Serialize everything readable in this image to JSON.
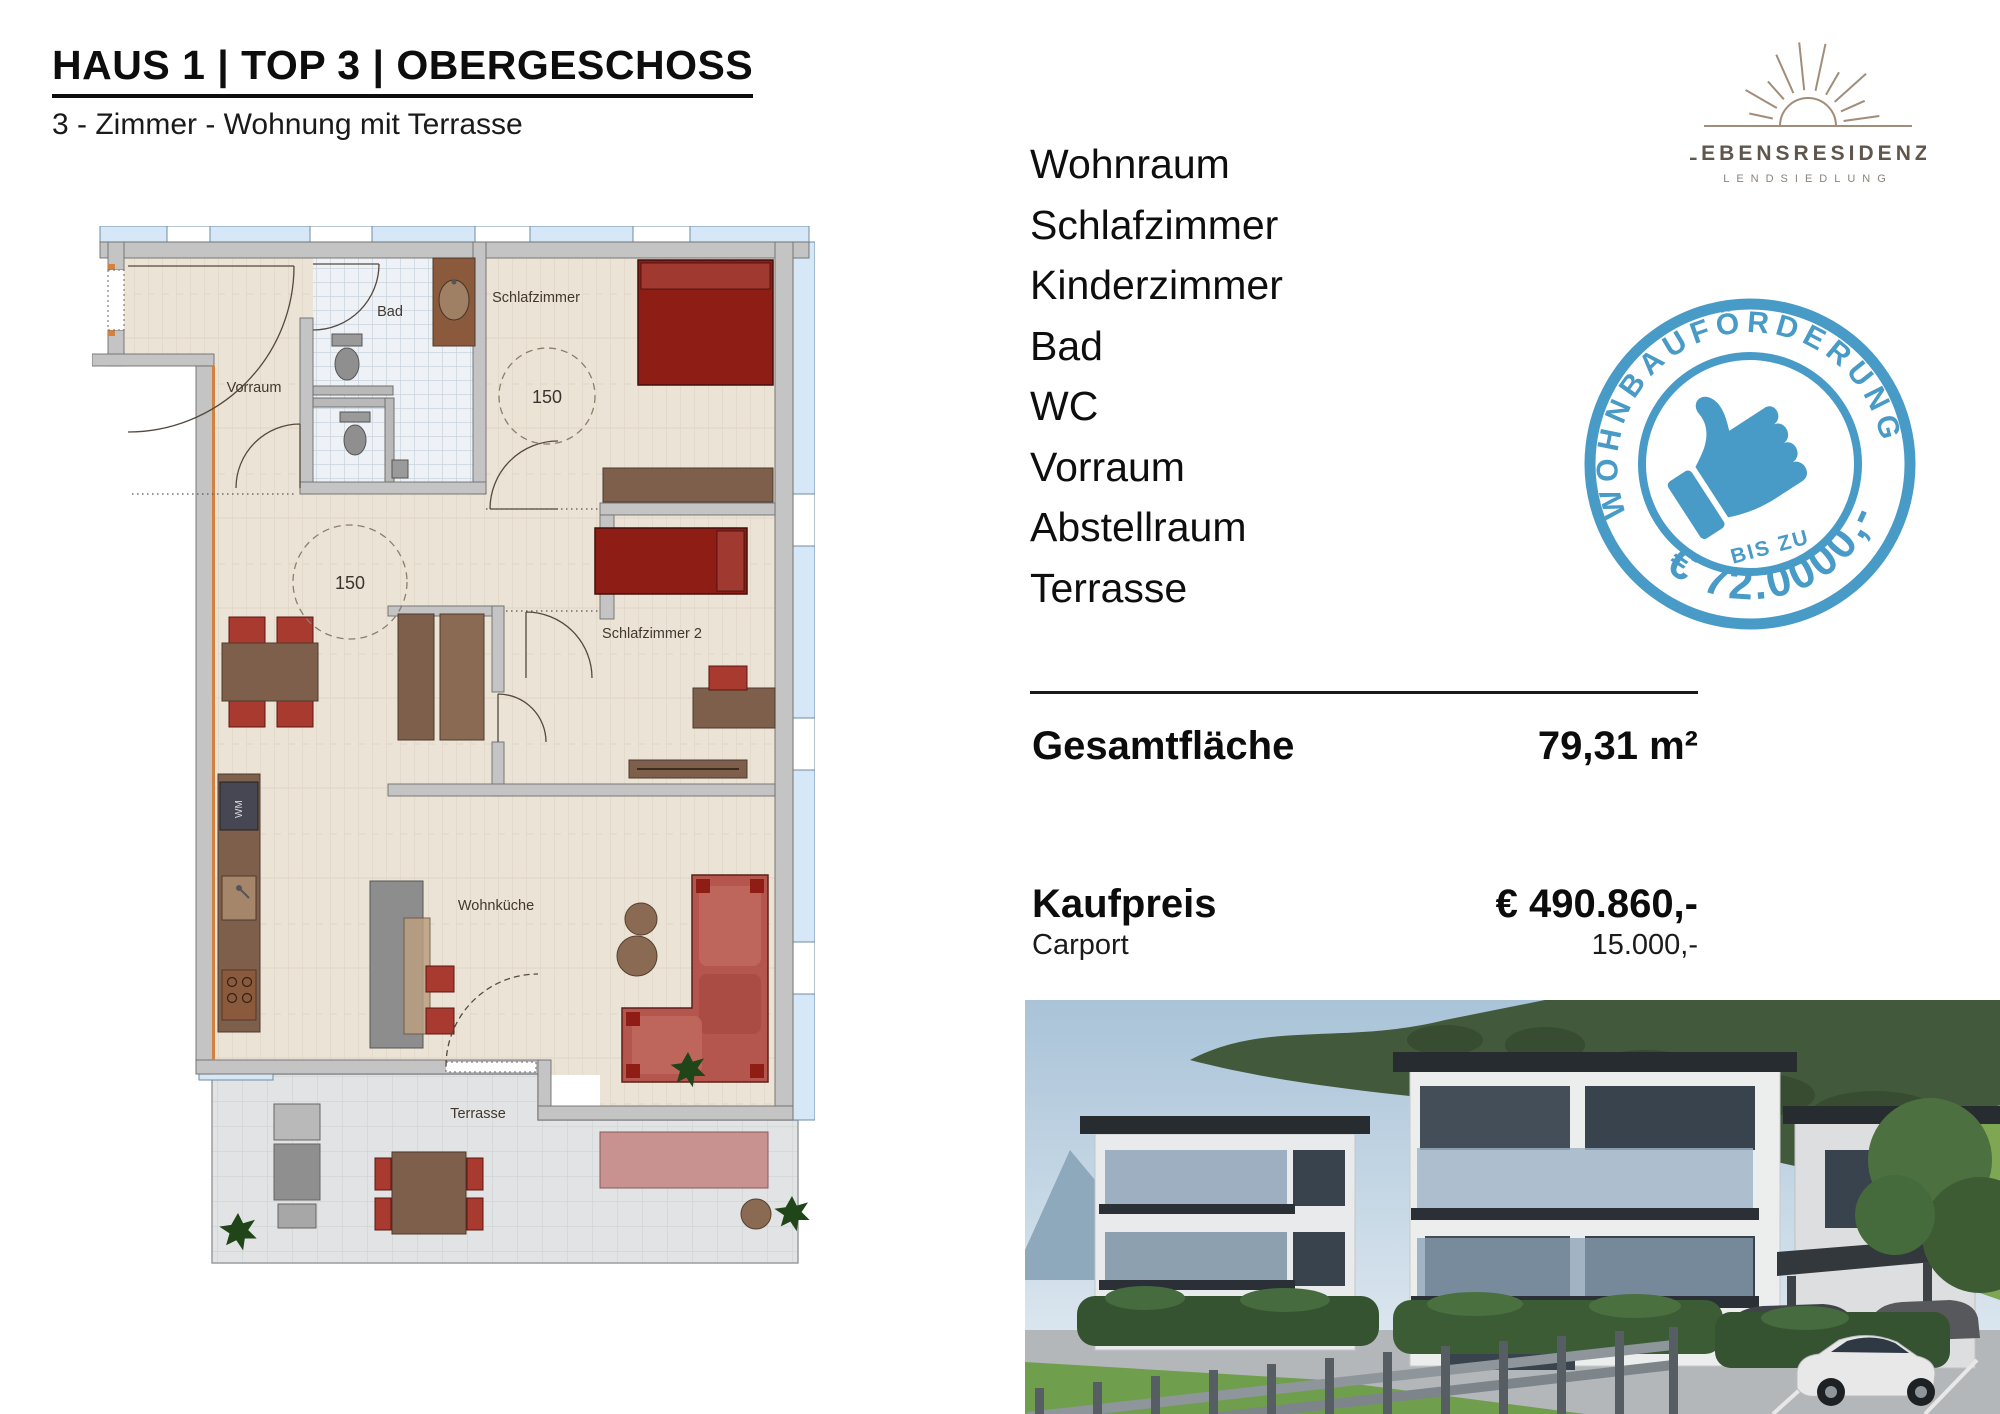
{
  "header": {
    "title": "HAUS 1 | TOP 3 | OBERGESCHOSS",
    "subtitle": "3 - Zimmer - Wohnung mit Terrasse"
  },
  "logo": {
    "name": "LEBENSRESIDENZ",
    "tagline": "LENDSIEDLUNG"
  },
  "stamp": {
    "top_text": "WOHNBAUFÖRDERUNG",
    "middle_text": "BIS ZU",
    "bottom_text": "€ 72.0000,-"
  },
  "rooms": [
    "Wohnraum",
    "Schlafzimmer",
    "Kinderzimmer",
    "Bad",
    "WC",
    "Vorraum",
    "Abstellraum",
    "Terrasse"
  ],
  "summary": {
    "area_label": "Gesamtfläche",
    "area_value": "79,31 m²",
    "price_label": "Kaufpreis",
    "price_value": "€ 490.860,-",
    "carport_label": "Carport",
    "carport_value": "15.000,-"
  },
  "floorplan": {
    "labels": {
      "vorraum": "Vorraum",
      "bad": "Bad",
      "schlafzimmer": "Schlafzimmer",
      "schlafzimmer2": "Schlafzimmer 2",
      "wohnkueche": "Wohnküche",
      "terrasse": "Terrasse",
      "wm": "WM",
      "circle1": "150",
      "circle2": "150"
    }
  },
  "colors": {
    "stamp_blue": "#3f95c5",
    "logo_sun": "#a08d7a",
    "logo_text": "#5f574e",
    "plan_window": "#d6e7f7",
    "plan_wall": "#c4c4c4",
    "plan_floor": "#ebe3d6",
    "furniture_red": "#a83a30",
    "bed_red": "#8e1d16",
    "furniture_brown": "#7d5f4b"
  }
}
